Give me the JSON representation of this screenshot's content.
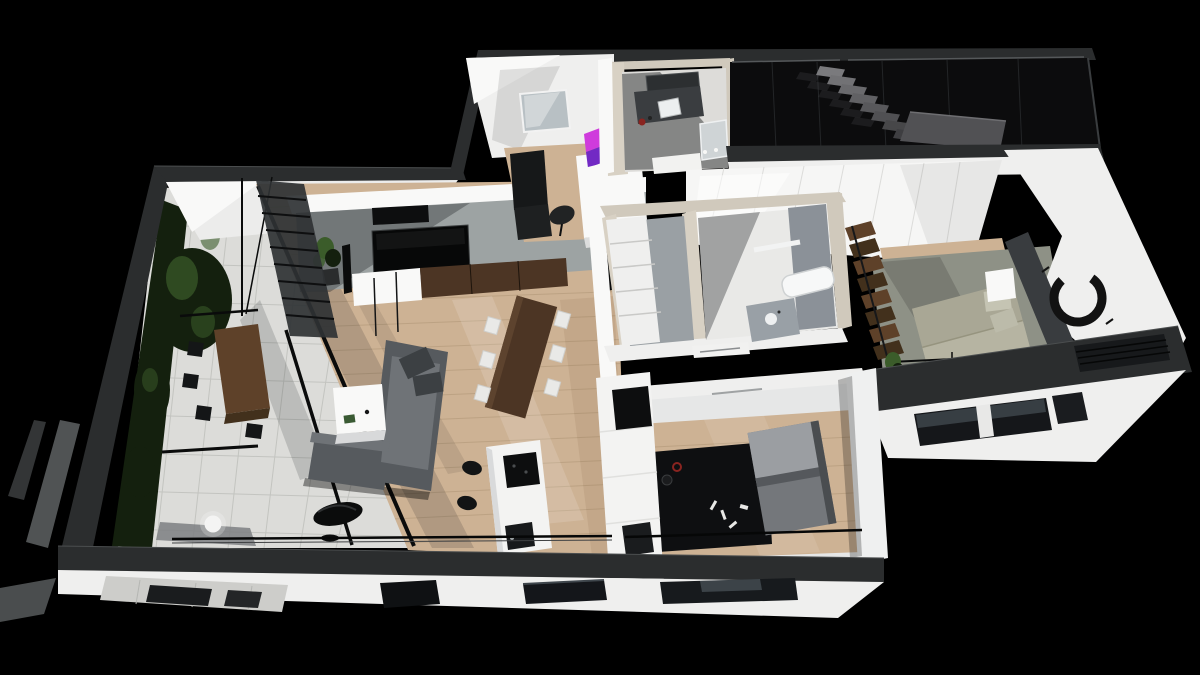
{
  "scene": {
    "title": "3D axonometric cutaway render of a single-level apartment floor plan on a black background",
    "view": "axonometric-cutaway-top",
    "background_note": "pure black studio backdrop, white cut walls with dark charcoal wall-top band",
    "rooms": [
      {
        "name": "terrace-winter-garden",
        "floor": "large white pavers",
        "features": [
          "vertical greenery",
          "wood outdoor table",
          "black chairs",
          "glass enclosure",
          "sphere lamp"
        ]
      },
      {
        "name": "living-room",
        "floor": "light oak planks",
        "features": [
          "L-shaped gray sectional sofa",
          "white coffee table",
          "black sculptural side table",
          "concrete TV wall",
          "wall TV",
          "media console",
          "floor speakers",
          "potted plant"
        ]
      },
      {
        "name": "dining-area",
        "floor": "light oak planks",
        "features": [
          "dark walnut table",
          "six white chairs"
        ]
      },
      {
        "name": "kitchen",
        "floor": "light oak planks",
        "features": [
          "white island",
          "black cooktop",
          "black sink",
          "two black bar stools",
          "tall white cabinet column with black built-in"
        ]
      },
      {
        "name": "home-office-nook",
        "floor": "light oak planks",
        "features": [
          "white desk",
          "magenta-lit monitor",
          "black cabinet",
          "black task chair",
          "window"
        ]
      },
      {
        "name": "upper-bathroom",
        "floor": "stone",
        "features": [
          "travertine walls",
          "charcoal vanity counter",
          "white sink",
          "mirror",
          "red kettle accent"
        ]
      },
      {
        "name": "walk-in-wardrobe",
        "floor": "white",
        "features": [
          "white shelving",
          "gray back wall"
        ]
      },
      {
        "name": "inner-bathroom",
        "floor": "white",
        "features": [
          "gray walls",
          "white bathtub",
          "vanity with round sink"
        ]
      },
      {
        "name": "hallway-closet",
        "floor": "white",
        "features": [
          "glossy white wardrobe panels"
        ]
      },
      {
        "name": "staircase-void",
        "floor": "glossy black glass",
        "features": [
          "gray cantilevered steps",
          "landing platform",
          "glass balustrade"
        ]
      },
      {
        "name": "bedroom",
        "floor": "sage carpet over oak",
        "features": [
          "sage green bed with pillows",
          "charcoal headboard wall",
          "white nightstand",
          "black enso brush-circle wall art",
          "folded wood stair",
          "glass railing",
          "small plant"
        ]
      },
      {
        "name": "guest-room",
        "floor": "light oak planks",
        "features": [
          "black rug with small props",
          "gray two-tone sofa",
          "white wardrobe wall",
          "ceiling vent"
        ]
      },
      {
        "name": "south-facade",
        "floor": "",
        "features": [
          "white band with recessed dark windows",
          "paver sliver",
          "charcoal cut band"
        ]
      },
      {
        "name": "east-facade-bedroom-wing",
        "floor": "",
        "features": [
          "white band with two dark windows",
          "dark louver grill"
        ]
      }
    ],
    "palette_note": "all colors listed under palette"
  },
  "palette": {
    "bg": "#000000",
    "band": "#2b2d2e",
    "band_highlight": "#4b4e4f",
    "wall_white": "#efefee",
    "wall_bright": "#f9f9f8",
    "wall_face": "#ececeb",
    "wall_shadow": "#c7c8c9",
    "travertine": "#d0c9bc",
    "travertine_light": "#d8d1c4",
    "wood": "#cdb294",
    "wood_line": "#a98e6e",
    "tile": "#dcdcd9",
    "tile_line": "#c3c4c0",
    "glass": "#0a0b0b",
    "concrete": "#9da3a3",
    "concrete_shadow": "#72777a",
    "sofa": "#565a5e",
    "sofa_light": "#6f7377",
    "sofa_pillow": "#3c4043",
    "walnut": "#4c3524",
    "chair_white": "#e9e9e7",
    "island": "#f3f3f2",
    "appliance": "#0d0e0f",
    "steel": "#b8c0c4",
    "bed_sage": "#a9a795",
    "bed_light": "#b6b4a2",
    "headboard": "#393c3f",
    "floor_sage": "#8e9186",
    "step_gray": "#6b6b6e",
    "landing_gray": "#515154",
    "gloss": "#0c0c0d",
    "closet": "#f6f6f5",
    "plant_dark": "#14200e",
    "plant_green": "#3b5c2a",
    "magenta": "#cf3bdc",
    "violet": "#7229c4",
    "rug": "#0e0f11",
    "red_accent": "#8a2420",
    "stair_wood": "#5e4129",
    "stair_wood_dark": "#42301c",
    "gray_band": "#505354"
  }
}
